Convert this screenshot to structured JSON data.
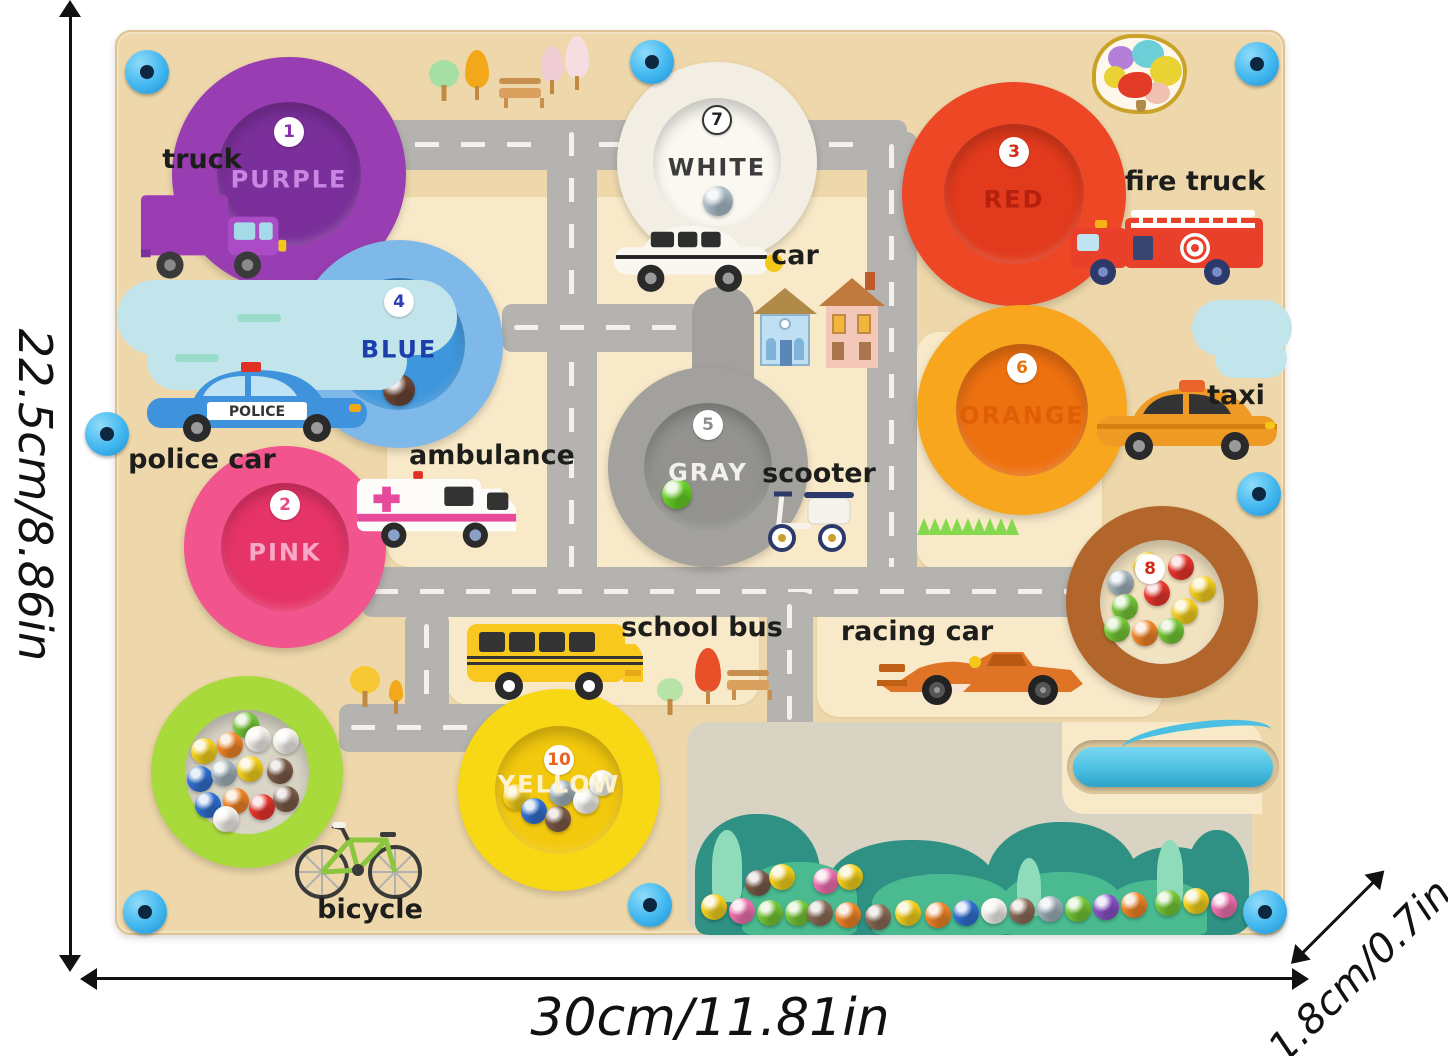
{
  "annotations": {
    "height_label": "22.5cm/8.86in",
    "width_label": "30cm/11.81in",
    "depth_label": "1.8cm/0.7in"
  },
  "board": {
    "circles": {
      "purple": {
        "number": "1",
        "label": "PURPLE",
        "ring": "#993db2",
        "inner": "#7b2f9a"
      },
      "pink": {
        "number": "2",
        "label": "PINK",
        "ring": "#f2558d",
        "inner": "#e73468"
      },
      "red": {
        "number": "3",
        "label": "RED",
        "ring": "#ee4726",
        "inner": "#e23a1c"
      },
      "blue": {
        "number": "4",
        "label": "BLUE",
        "ring": "#7fb9ea",
        "inner": "#3e97dd"
      },
      "gray": {
        "number": "5",
        "label": "GRAY",
        "ring": "#a3a19d",
        "inner": "#93928e"
      },
      "orange": {
        "number": "6",
        "label": "ORANGE",
        "ring": "#f7a61e",
        "inner": "#ee7110"
      },
      "white": {
        "number": "7",
        "label": "WHITE",
        "ring": "#f2eee4",
        "inner": "#faf8f1"
      },
      "brown": {
        "number": "8",
        "ring": "#b2662c",
        "inner": "#f2e3c0"
      },
      "yellow": {
        "number": "10",
        "label": "YELLOW",
        "ring": "#f8d715",
        "inner": "#f3c90e"
      },
      "green": {
        "ring": "#a8da3c",
        "inner": "#d8d4c6"
      }
    },
    "vehicle_labels": {
      "truck": "truck",
      "car": "car",
      "fire_truck": "fire truck",
      "police_car": "police car",
      "ambulance": "ambulance",
      "taxi": "taxi",
      "scooter": "scooter",
      "school_bus": "school bus",
      "racing_car": "racing car",
      "bicycle": "bicycle"
    },
    "police_banner": "POLICE",
    "colors": {
      "board_tan": "#eed8ab",
      "block_cream": "#f8e9c8",
      "road_gray": "#b5b3af",
      "road_dash": "#f4f1ea",
      "screw_blue": "#41b7ef",
      "pen_cyan": "#4cc0e2",
      "window_bg": "#d8d3c2",
      "bush_dark": "#2f9183",
      "bush_light": "#4abb91"
    },
    "balls": {
      "white_well": [
        {
          "x": 50,
          "y": 88,
          "c": "#a9bbc6",
          "s": 30
        }
      ],
      "blue_well": [
        {
          "x": 50,
          "y": 96,
          "c": "#6b4434",
          "s": 32
        }
      ],
      "gray_well": [
        {
          "x": 18,
          "y": 76,
          "c": "#66cf27",
          "s": 30
        }
      ],
      "brown_well": [
        {
          "x": 8,
          "y": 30,
          "c": "#9fb0ba"
        },
        {
          "x": 34,
          "y": 12,
          "c": "#f3cf1c"
        },
        {
          "x": 68,
          "y": 14,
          "c": "#e8352c"
        },
        {
          "x": 90,
          "y": 36,
          "c": "#f3cf1c"
        },
        {
          "x": 12,
          "y": 54,
          "c": "#74c636"
        },
        {
          "x": 44,
          "y": 40,
          "c": "#e8352c"
        },
        {
          "x": 72,
          "y": 58,
          "c": "#f3cf1c"
        },
        {
          "x": 4,
          "y": 76,
          "c": "#74c636"
        },
        {
          "x": 32,
          "y": 80,
          "c": "#ef8326"
        },
        {
          "x": 58,
          "y": 78,
          "c": "#74c636"
        }
      ],
      "green_well": [
        {
          "x": 48,
          "y": 2,
          "c": "#74c636"
        },
        {
          "x": 6,
          "y": 28,
          "c": "#f3cf1c"
        },
        {
          "x": 32,
          "y": 22,
          "c": "#ef8326"
        },
        {
          "x": 60,
          "y": 16,
          "c": "#f2f0ea"
        },
        {
          "x": 88,
          "y": 18,
          "c": "#f2f0ea"
        },
        {
          "x": 2,
          "y": 56,
          "c": "#2f6fd0"
        },
        {
          "x": 26,
          "y": 50,
          "c": "#9fb0ba"
        },
        {
          "x": 52,
          "y": 46,
          "c": "#f3cf1c"
        },
        {
          "x": 82,
          "y": 48,
          "c": "#7a5a48"
        },
        {
          "x": 10,
          "y": 82,
          "c": "#2f6fd0"
        },
        {
          "x": 38,
          "y": 78,
          "c": "#ef8326"
        },
        {
          "x": 64,
          "y": 84,
          "c": "#e8352c"
        },
        {
          "x": 28,
          "y": 96,
          "c": "#f2f0ea"
        },
        {
          "x": 88,
          "y": 76,
          "c": "#7a5a48"
        }
      ],
      "yellow_well": [
        {
          "x": 8,
          "y": 58,
          "c": "#f3cf1c"
        },
        {
          "x": 26,
          "y": 72,
          "c": "#2f6fd0"
        },
        {
          "x": 50,
          "y": 80,
          "c": "#7a5a48"
        },
        {
          "x": 54,
          "y": 54,
          "c": "#9fb0ba"
        },
        {
          "x": 78,
          "y": 62,
          "c": "#f2f0ea"
        },
        {
          "x": 94,
          "y": 44,
          "c": "#f2f0ea"
        }
      ],
      "window": [
        {
          "x": 14,
          "y": 172,
          "c": "#f3cf1c"
        },
        {
          "x": 42,
          "y": 176,
          "c": "#ee6fae"
        },
        {
          "x": 58,
          "y": 148,
          "c": "#7a5a48"
        },
        {
          "x": 82,
          "y": 142,
          "c": "#f3cf1c"
        },
        {
          "x": 70,
          "y": 178,
          "c": "#74c636"
        },
        {
          "x": 98,
          "y": 178,
          "c": "#74c636"
        },
        {
          "x": 126,
          "y": 146,
          "c": "#ee6fae"
        },
        {
          "x": 150,
          "y": 142,
          "c": "#f3cf1c"
        },
        {
          "x": 120,
          "y": 178,
          "c": "#8a6a55"
        },
        {
          "x": 148,
          "y": 180,
          "c": "#ef8326"
        },
        {
          "x": 178,
          "y": 182,
          "c": "#8a6a55"
        },
        {
          "x": 208,
          "y": 178,
          "c": "#f3cf1c"
        },
        {
          "x": 238,
          "y": 180,
          "c": "#ef8326"
        },
        {
          "x": 266,
          "y": 178,
          "c": "#2f6fd0"
        },
        {
          "x": 294,
          "y": 176,
          "c": "#f2f0ea"
        },
        {
          "x": 322,
          "y": 176,
          "c": "#8a6a55"
        },
        {
          "x": 350,
          "y": 174,
          "c": "#9fb0ba"
        },
        {
          "x": 378,
          "y": 174,
          "c": "#74c636"
        },
        {
          "x": 406,
          "y": 172,
          "c": "#8b4fc8"
        },
        {
          "x": 434,
          "y": 170,
          "c": "#ef8326"
        },
        {
          "x": 468,
          "y": 168,
          "c": "#74c636"
        },
        {
          "x": 496,
          "y": 166,
          "c": "#f3cf1c"
        },
        {
          "x": 524,
          "y": 170,
          "c": "#ee6fae"
        }
      ]
    }
  }
}
